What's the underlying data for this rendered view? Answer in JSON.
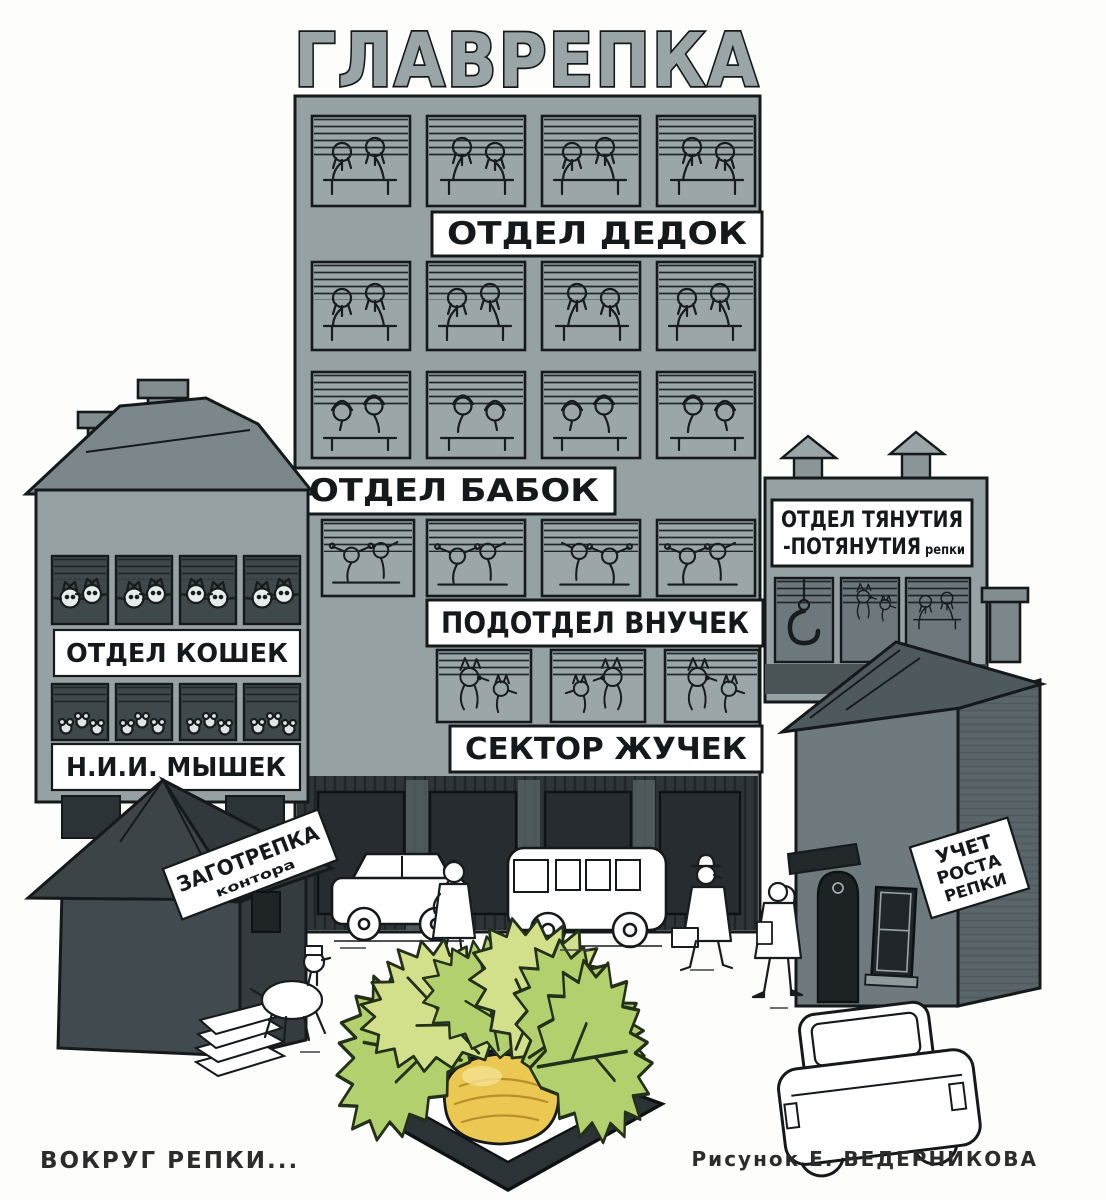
{
  "artwork": {
    "caption_left": "ВОКРУГ РЕПКИ...",
    "caption_right": "Рисунок Е. ВЕДЕРНИКОВА"
  },
  "main_building": {
    "rooftop_sign": "ГЛАВРЕПКА",
    "floor_signs": [
      "ОТДЕЛ ДЕДОК",
      "ОТДЕЛ БАБОК",
      "ПОДОТДЕЛ ВНУЧЕК",
      "СЕКТОР ЖУЧЕК"
    ]
  },
  "left_building": {
    "upper_sign": "ОТДЕЛ КОШЕК",
    "lower_sign": "Н.И.И. МЫШЕК"
  },
  "kiosk": {
    "sign_title": "ЗАГОТРЕПКА",
    "sign_subtitle": "контора"
  },
  "right_building": {
    "sign_line1": "ОТДЕЛ ТЯНУТИЯ",
    "sign_line2": "-ПОТЯНУТИЯ",
    "sign_line2_note": "репки"
  },
  "right_house": {
    "sign_line1": "УЧЕТ",
    "sign_line2": "РОСТА",
    "sign_line3": "РЕПКИ"
  },
  "colors": {
    "facade_gray": "#96a1a4",
    "roof_gray": "#7b878b",
    "dark_base": "#2e3437",
    "planter_dark": "#2c3336",
    "ink": "#15191b",
    "paper_white": "#ffffff",
    "leaf_green": "#b2d06e",
    "leaf_light": "#d2e08c",
    "turnip_yellow": "#ebc851",
    "turnip_shade": "#b98f2e"
  }
}
